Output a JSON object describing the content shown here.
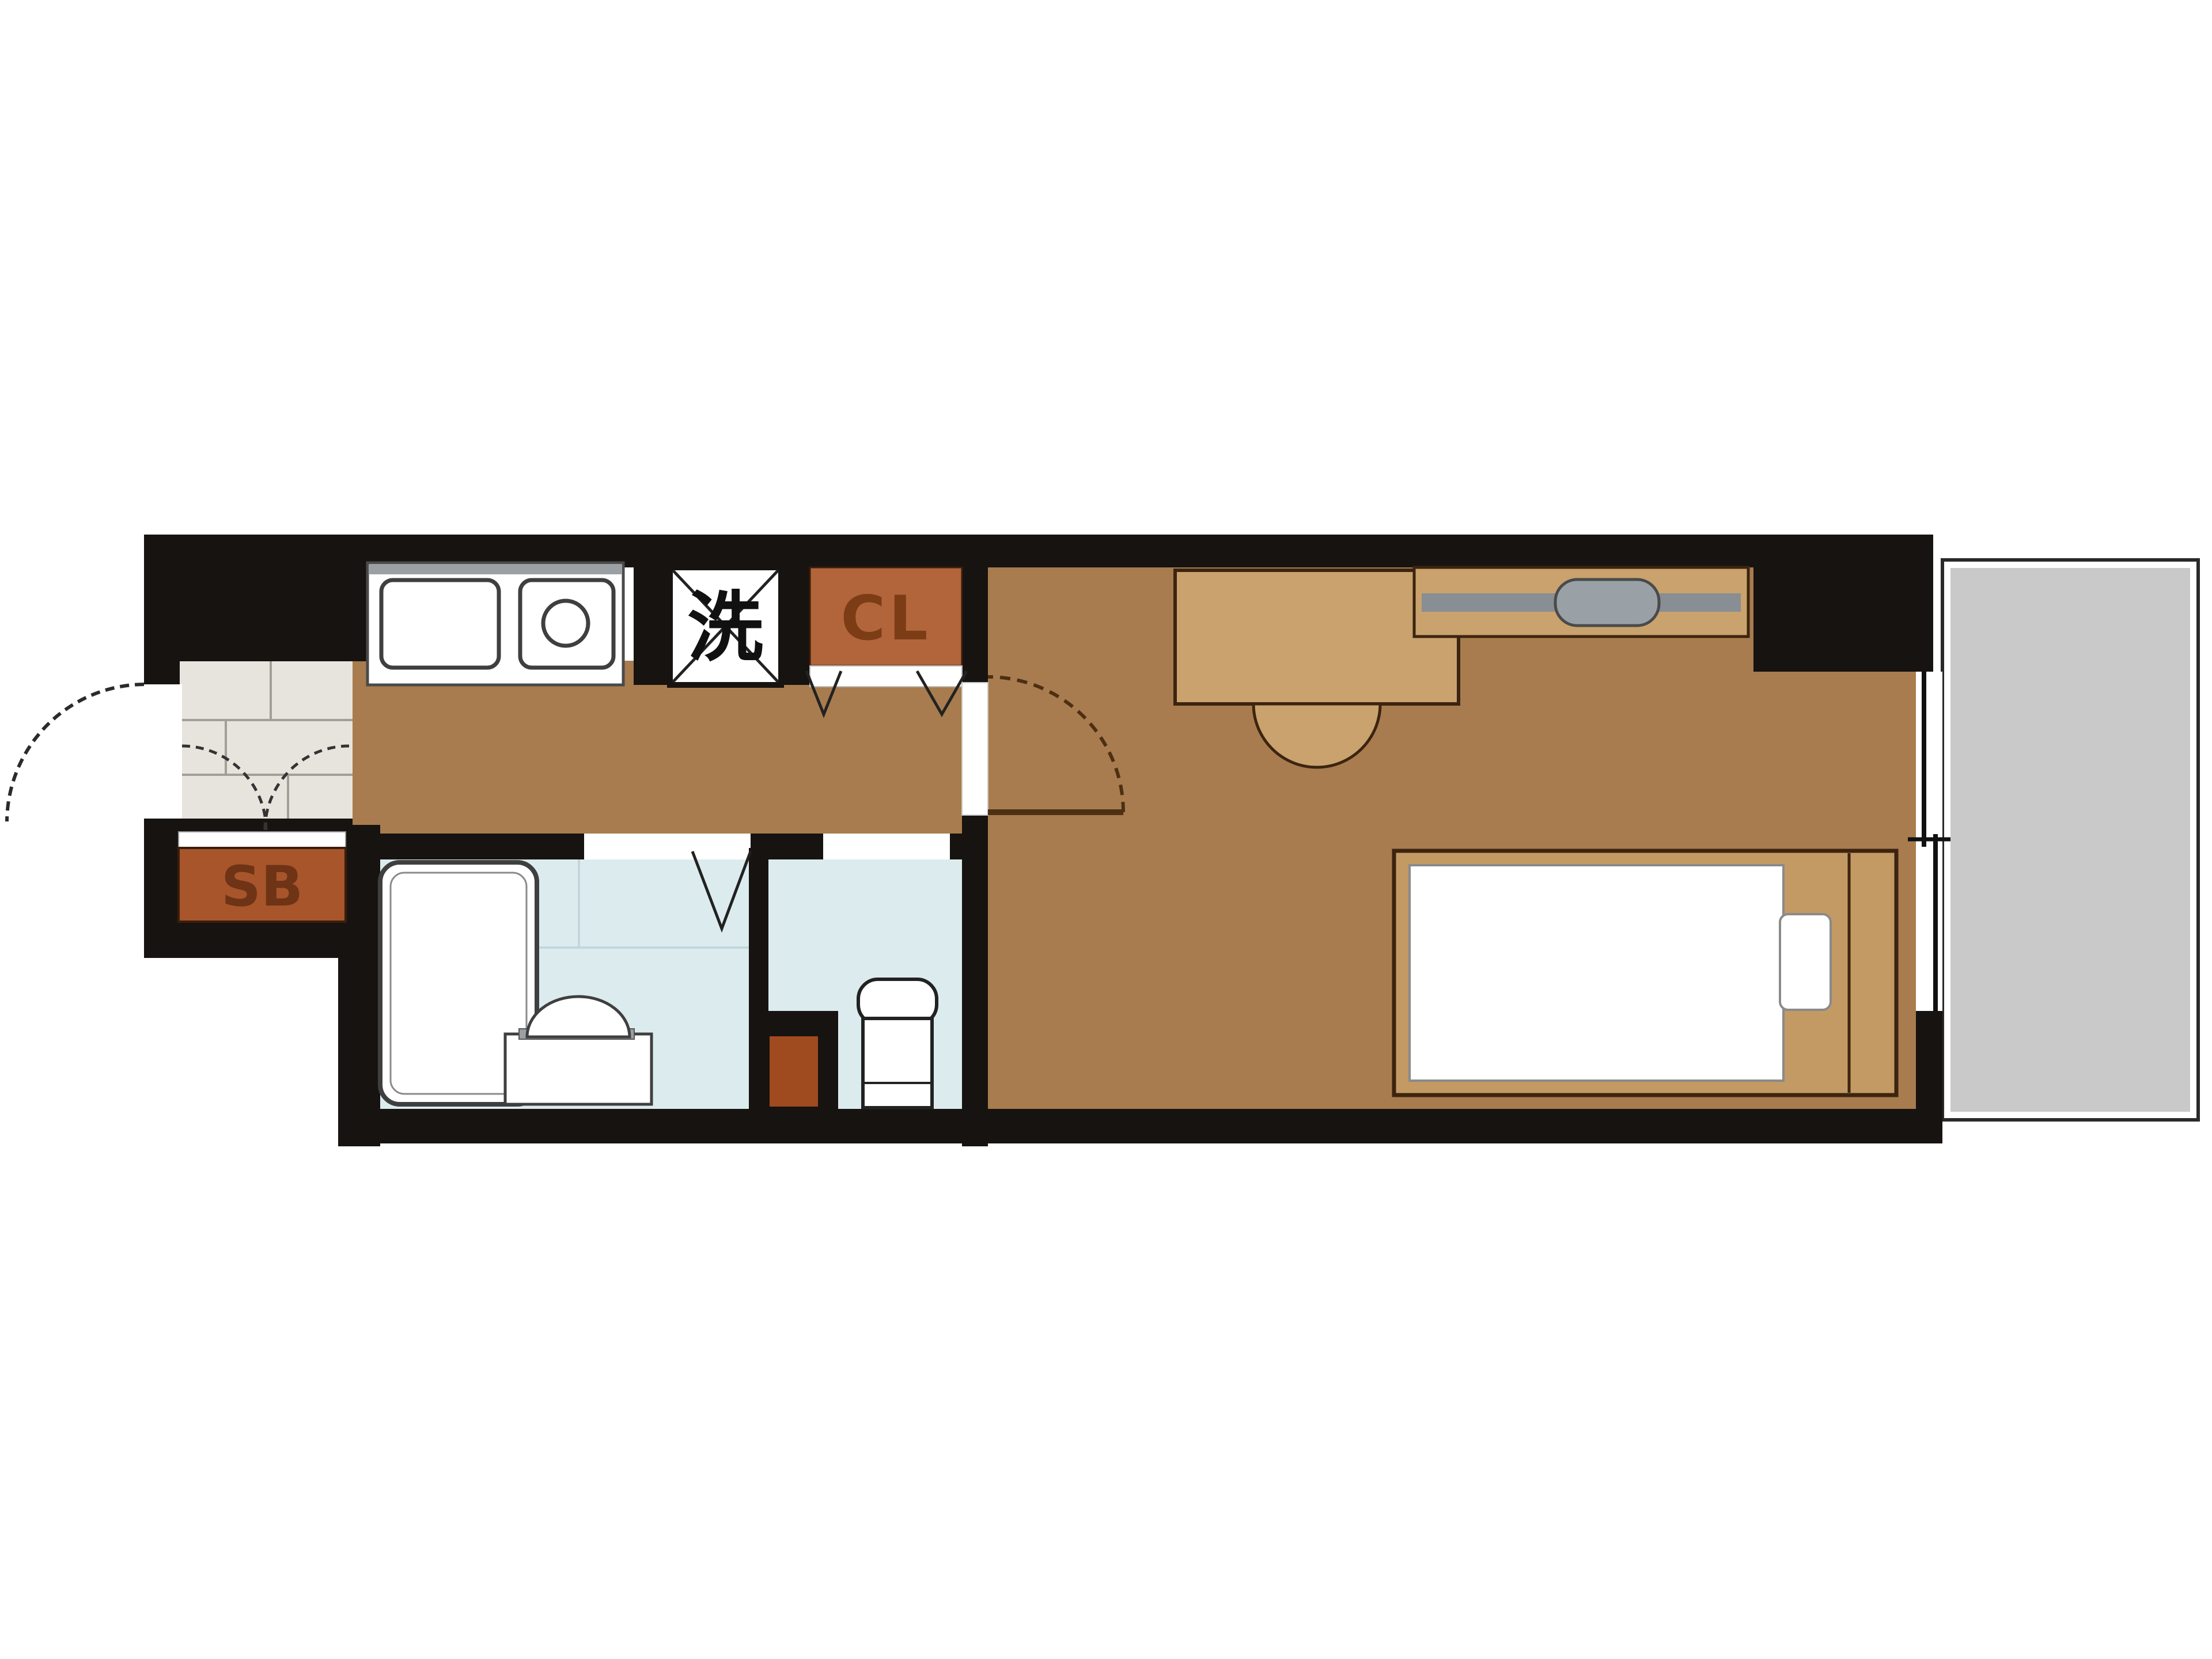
{
  "plan": {
    "labels": {
      "shoe_box": "SB",
      "washing_machine": "洗",
      "closet": "CL"
    },
    "colors": {
      "wall": "#171310",
      "floor": "#a87c4e",
      "tile": "#e7e4de",
      "bath_floor": "#dcebee",
      "balcony": "#c9c9c9",
      "shoe_box_fill": "#a8552b",
      "closet_fill": "#b2653a",
      "cabinet_dark": "#a04a20",
      "furniture_tan": "#c9a26d",
      "bed_tan": "#c39a63",
      "appliance_gray": "#878e94",
      "door_arc": "#4d2f13",
      "label_dark": "#6f3315"
    }
  }
}
